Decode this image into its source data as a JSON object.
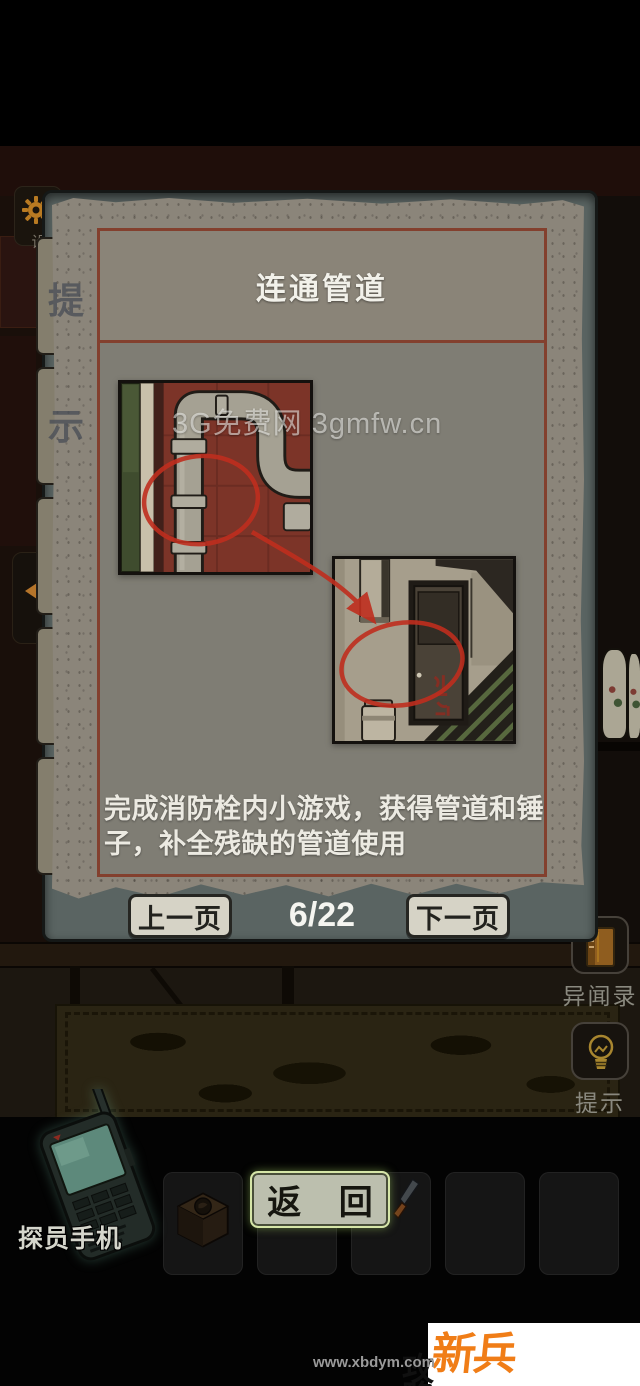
{
  "panel": {
    "title": "连通管道",
    "description": "完成消防栓内小游戏，获得管道和锤子，补全残缺的管道使用",
    "inline_watermark": "3G免费网 3gmfw.cn",
    "tabs": [
      {
        "label": "提"
      },
      {
        "label": "示"
      }
    ],
    "pagination": {
      "prev": "上一页",
      "current": "6/22",
      "next": "下一页"
    }
  },
  "side_panel": {
    "settings_label": "设",
    "records_label": "异闻录",
    "hint_label": "提示"
  },
  "inventory": {
    "phone_label": "探员手机",
    "return_label": "返 回"
  },
  "footer": {
    "brand_primary": "新兵",
    "brand_secondary": "攻略网",
    "url": "www.xbdym.com"
  },
  "icons": {
    "settings": "gear-icon",
    "back": "chevron-left-icon",
    "records": "notebook-icon",
    "hint": "light-bulb-icon",
    "phone": "retro-phone-icon",
    "slot_item_1": "compass-box-icon",
    "slot_item_3": "knife-icon"
  },
  "colors": {
    "annotation_red": "#bf2e1e",
    "panel_border_red": "#83402e",
    "paper": "#8b857a",
    "board": "#5a6462",
    "return_button_bg": "#bcbfae",
    "return_button_border": "#d6e6a8",
    "brand_orange": "#f07d17"
  }
}
